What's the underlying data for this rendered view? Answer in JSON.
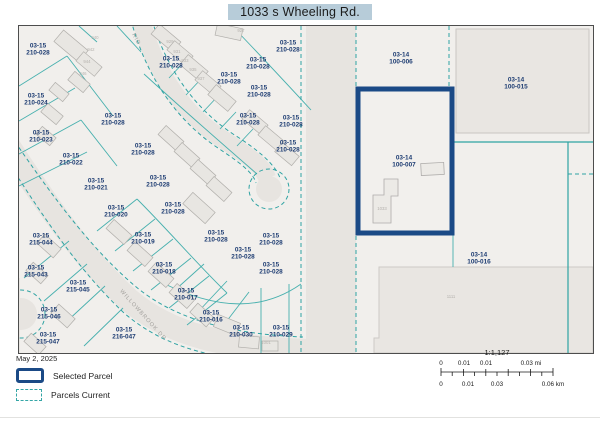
{
  "title": "1033 s Wheeling Rd.",
  "legend": {
    "date": "May 2, 2025",
    "selected_label": "Selected Parcel",
    "current_label": "Parcels Current"
  },
  "scalebar": {
    "ratio": "1:1,127",
    "mi_labels": [
      {
        "t": "0",
        "x": 26
      },
      {
        "t": "0.01",
        "x": 49
      },
      {
        "t": "0.01",
        "x": 71
      },
      {
        "t": "0.03 mi",
        "x": 116
      }
    ],
    "km_labels": [
      {
        "t": "0",
        "x": 26
      },
      {
        "t": "0.01",
        "x": 53
      },
      {
        "t": "0.03",
        "x": 82
      },
      {
        "t": "0.06 km",
        "x": 138
      }
    ]
  },
  "colors": {
    "selected_parcel_border": "#1b4a86",
    "parcel_line_teal": "#2fa3a3",
    "label_navy": "#1d3c72",
    "title_highlight": "#b7ccd9",
    "map_background": "#f1efec"
  },
  "map": {
    "parcel_labels": [
      {
        "l1": "03-15",
        "l2": "210-028",
        "x": 19,
        "y": 23
      },
      {
        "l1": "03-15",
        "l2": "210-028",
        "x": 152,
        "y": 36
      },
      {
        "l1": "03-15",
        "l2": "210-028",
        "x": 269,
        "y": 20
      },
      {
        "l1": "03-15",
        "l2": "210-028",
        "x": 239,
        "y": 37
      },
      {
        "l1": "03-15",
        "l2": "210-028",
        "x": 210,
        "y": 52
      },
      {
        "l1": "03-15",
        "l2": "210-028",
        "x": 240,
        "y": 65
      },
      {
        "l1": "03-15",
        "l2": "210-028",
        "x": 229,
        "y": 93
      },
      {
        "l1": "03-15",
        "l2": "210-028",
        "x": 272,
        "y": 95
      },
      {
        "l1": "03-15",
        "l2": "210-028",
        "x": 269,
        "y": 120
      },
      {
        "l1": "03-15",
        "l2": "210-024",
        "x": 17,
        "y": 73
      },
      {
        "l1": "03-15",
        "l2": "210-023",
        "x": 22,
        "y": 110
      },
      {
        "l1": "03-15",
        "l2": "210-028",
        "x": 94,
        "y": 93
      },
      {
        "l1": "03-15",
        "l2": "210-028",
        "x": 124,
        "y": 123
      },
      {
        "l1": "03-15",
        "l2": "210-022",
        "x": 52,
        "y": 133
      },
      {
        "l1": "03-15",
        "l2": "210-021",
        "x": 77,
        "y": 158
      },
      {
        "l1": "03-15",
        "l2": "210-020",
        "x": 97,
        "y": 185
      },
      {
        "l1": "03-15",
        "l2": "210-028",
        "x": 139,
        "y": 155
      },
      {
        "l1": "03-15",
        "l2": "210-028",
        "x": 154,
        "y": 182
      },
      {
        "l1": "03-15",
        "l2": "215-044",
        "x": 22,
        "y": 213
      },
      {
        "l1": "03-15",
        "l2": "210-019",
        "x": 124,
        "y": 212
      },
      {
        "l1": "03-15",
        "l2": "210-028",
        "x": 197,
        "y": 210
      },
      {
        "l1": "03-15",
        "l2": "210-028",
        "x": 252,
        "y": 213
      },
      {
        "l1": "03-15",
        "l2": "210-028",
        "x": 224,
        "y": 227
      },
      {
        "l1": "03-15",
        "l2": "210-028",
        "x": 252,
        "y": 242
      },
      {
        "l1": "03-15",
        "l2": "215-043",
        "x": 17,
        "y": 245
      },
      {
        "l1": "03-15",
        "l2": "215-045",
        "x": 59,
        "y": 260
      },
      {
        "l1": "03-15",
        "l2": "210-018",
        "x": 145,
        "y": 242
      },
      {
        "l1": "03-15",
        "l2": "215-046",
        "x": 30,
        "y": 287
      },
      {
        "l1": "03-15",
        "l2": "210-017",
        "x": 167,
        "y": 268
      },
      {
        "l1": "03-15",
        "l2": "215-047",
        "x": 29,
        "y": 312
      },
      {
        "l1": "03-15",
        "l2": "216-047",
        "x": 105,
        "y": 307
      },
      {
        "l1": "03-15",
        "l2": "210-016",
        "x": 192,
        "y": 290
      },
      {
        "l1": "03-15",
        "l2": "210-030",
        "x": 222,
        "y": 305
      },
      {
        "l1": "03-15",
        "l2": "210-029",
        "x": 262,
        "y": 305
      },
      {
        "l1": "03-14",
        "l2": "100-006",
        "x": 382,
        "y": 32
      },
      {
        "l1": "03-14",
        "l2": "100-015",
        "x": 497,
        "y": 57
      },
      {
        "l1": "03-14",
        "l2": "100-007",
        "x": 385,
        "y": 135
      },
      {
        "l1": "03-14",
        "l2": "100-016",
        "x": 460,
        "y": 232
      }
    ],
    "road_labels": [
      {
        "text": "WILLOWBROOK DR",
        "x": 123,
        "y": 290,
        "rot": 48
      },
      {
        "text": "RID",
        "x": 116,
        "y": 14,
        "rot": 62
      }
    ],
    "building_numbers": [
      {
        "t": "940",
        "x": 76,
        "y": 13
      },
      {
        "t": "942",
        "x": 72,
        "y": 25
      },
      {
        "t": "944",
        "x": 68,
        "y": 37
      },
      {
        "t": "946",
        "x": 64,
        "y": 49
      },
      {
        "t": "929",
        "x": 151,
        "y": 17
      },
      {
        "t": "931",
        "x": 158,
        "y": 27
      },
      {
        "t": "933",
        "x": 166,
        "y": 36
      },
      {
        "t": "935",
        "x": 174,
        "y": 45
      },
      {
        "t": "937",
        "x": 182,
        "y": 54
      },
      {
        "t": "927",
        "x": 222,
        "y": 6
      },
      {
        "t": "1033",
        "x": 363,
        "y": 184
      },
      {
        "t": "1111",
        "x": 432,
        "y": 272
      },
      {
        "t": "1001",
        "x": 247,
        "y": 318
      }
    ]
  }
}
